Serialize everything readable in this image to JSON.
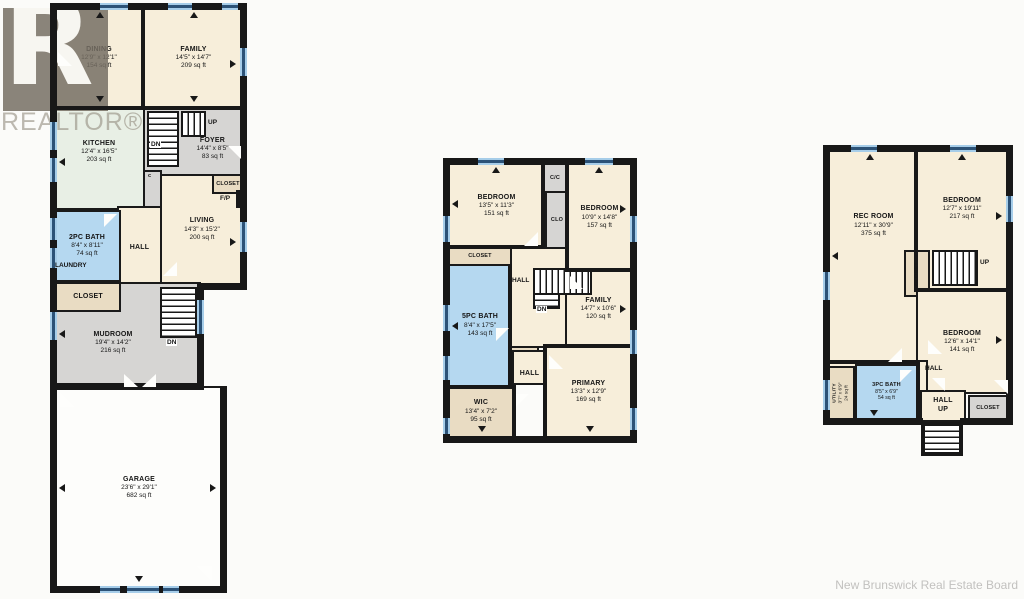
{
  "watermark": {
    "logo_letter": "R",
    "brand": "REALTOR®"
  },
  "footer": {
    "credit": "New Brunswick Real Estate Board"
  },
  "colors": {
    "room_cream": "#f7eeda",
    "room_tan": "#e9dcc3",
    "room_gray": "#d6d5d3",
    "room_blue": "#b5d8f0",
    "room_green": "#e8efe5",
    "wall": "#181818",
    "window_blue": "#2c5277"
  },
  "plans": [
    {
      "id": "main-floor",
      "rooms": [
        {
          "name": "DINING",
          "dims": "12'9\" x 12'1\"",
          "area": "154 sq ft"
        },
        {
          "name": "FAMILY",
          "dims": "14'5\" x 14'7\"",
          "area": "209 sq ft"
        },
        {
          "name": "KITCHEN",
          "dims": "12'4\" x 16'5\"",
          "area": "203 sq ft"
        },
        {
          "name": "FOYER",
          "dims": "14'4\" x 8'5\"",
          "area": "83 sq ft"
        },
        {
          "name": "LIVING",
          "dims": "14'3\" x 15'2\"",
          "area": "200 sq ft"
        },
        {
          "name": "2PC BATH",
          "dims": "8'4\" x 8'11\"",
          "area": "74 sq ft"
        },
        {
          "name": "MUDROOM",
          "dims": "19'4\" x 14'2\"",
          "area": "216 sq ft"
        },
        {
          "name": "GARAGE",
          "dims": "23'6\" x 29'1\"",
          "area": "682 sq ft"
        }
      ],
      "labels": {
        "up": "UP",
        "dn_stairs": "DN",
        "closet_foyer": "CLOSET",
        "fireplace": "F/P",
        "door_c": "c",
        "hall": "HALL",
        "laundry": "LAUNDRY",
        "closet_hall": "CLOSET",
        "dn_mudroom": "DN"
      }
    },
    {
      "id": "second-floor",
      "rooms": [
        {
          "name": "BEDROOM",
          "dims": "13'5\" x 11'3\"",
          "area": "151 sq ft"
        },
        {
          "name": "BEDROOM",
          "dims": "10'9\" x 14'8\"",
          "area": "157 sq ft"
        },
        {
          "name": "FAMILY",
          "dims": "14'7\" x 10'6\"",
          "area": "120 sq ft"
        },
        {
          "name": "5PC BATH",
          "dims": "8'4\" x 17'5\"",
          "area": "143 sq ft"
        },
        {
          "name": "PRIMARY",
          "dims": "13'3\" x 12'9\"",
          "area": "169 sq ft"
        },
        {
          "name": "WIC",
          "dims": "13'4\" x 7'2\"",
          "area": "95 sq ft"
        }
      ],
      "labels": {
        "cc": "C/C",
        "clo_upper": "CLO",
        "closet": "CLOSET",
        "hall_upper": "HALL",
        "dn": "DN",
        "clo_lower": "CLO",
        "hall_lower": "HALL"
      }
    },
    {
      "id": "basement",
      "rooms": [
        {
          "name": "REC ROOM",
          "dims": "12'11\" x 30'9\"",
          "area": "375 sq ft"
        },
        {
          "name": "BEDROOM",
          "dims": "12'7\" x 19'11\"",
          "area": "217 sq ft"
        },
        {
          "name": "BEDROOM",
          "dims": "12'6\" x 14'1\"",
          "area": "141 sq ft"
        },
        {
          "name": "UTILITY",
          "dims": "3'7\" x 6'9\"",
          "area": "24 sq ft"
        },
        {
          "name": "3PC BATH",
          "dims": "8'5\" x 6'9\"",
          "area": "54 sq ft"
        }
      ],
      "labels": {
        "closet_stairs": "CLOSET",
        "up": "UP",
        "hall": "HALL",
        "hall_up_1": "HALL",
        "hall_up_2": "UP",
        "closet_br": "CLOSET"
      }
    }
  ]
}
